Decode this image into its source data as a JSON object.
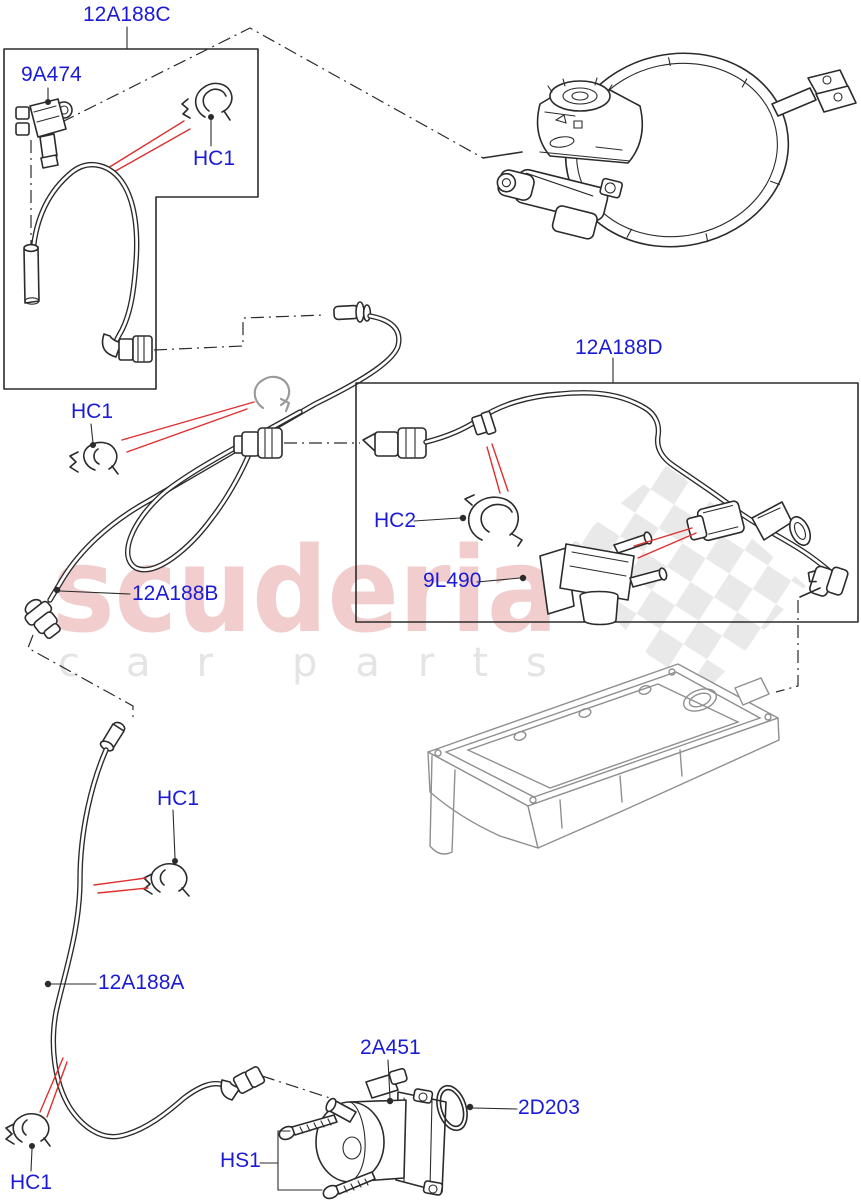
{
  "page": {
    "width": 861,
    "height": 1200
  },
  "colors": {
    "background": "#ffffff",
    "label_blue": "#1b1bd6",
    "arrow_red": "#e03030",
    "line_dark": "#2b2b2b",
    "part_gray": "#9a9a9a",
    "cover_gray": "#8f8f8f",
    "watermark_pink": "#f2cdcd",
    "watermark_gray": "#e4e4e4",
    "checker_gray": "#e9e9e9"
  },
  "watermark": {
    "brand": "scuderia",
    "tagline_left": "car",
    "tagline_right": "parts"
  },
  "callouts": [
    {
      "id": "12A188C",
      "text": "12A188C"
    },
    {
      "id": "9A474",
      "text": "9A474"
    },
    {
      "id": "HC1-top",
      "text": "HC1"
    },
    {
      "id": "HC1-mid",
      "text": "HC1"
    },
    {
      "id": "12A188D",
      "text": "12A188D"
    },
    {
      "id": "HC2",
      "text": "HC2"
    },
    {
      "id": "9L490",
      "text": "9L490"
    },
    {
      "id": "12A188B",
      "text": "12A188B"
    },
    {
      "id": "HC1-lower",
      "text": "HC1"
    },
    {
      "id": "12A188A",
      "text": "12A188A"
    },
    {
      "id": "HS1",
      "text": "HS1"
    },
    {
      "id": "HC1-bottom",
      "text": "HC1"
    },
    {
      "id": "2A451",
      "text": "2A451"
    },
    {
      "id": "2D203",
      "text": "2D203"
    }
  ]
}
